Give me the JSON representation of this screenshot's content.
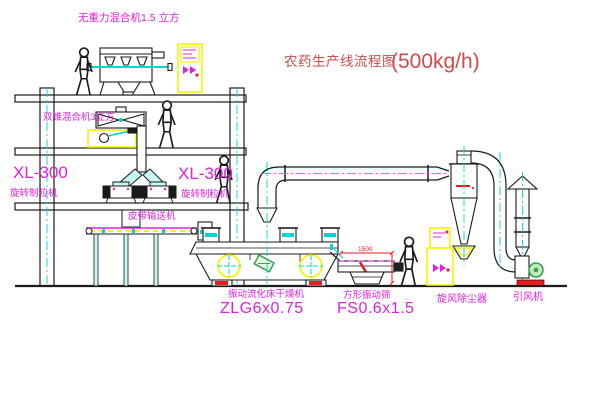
{
  "title": {
    "text": "农药生产线流程图",
    "capacity": "(500kg/h)"
  },
  "labels": {
    "gravity_mixer": "无重力混合机1.5 立方",
    "cone_mixer": "双锥混合机3立方",
    "granulator_model_left": "XL-300",
    "granulator_name_left": "旋转制粒机",
    "granulator_model_right": "XL-300",
    "granulator_name_right": "旋转制粒机",
    "belt_conveyor": "皮带输送机",
    "dryer_name": "振动流化床干燥机",
    "dryer_model": "ZLG6x0.75",
    "screen_name": "方形振动筛",
    "screen_model": "FS0.6x1.5",
    "cyclone": "旋风除尘器",
    "fan": "引风机"
  },
  "dims": {
    "screen_length": "1500"
  },
  "colors": {
    "label": "#e020e0",
    "title": "#cd4a4a",
    "line": "#1a1a1a",
    "cyan": "#00d5d5",
    "yellow": "#f5f500",
    "red": "#e81c1c",
    "green": "#2f9e44"
  }
}
